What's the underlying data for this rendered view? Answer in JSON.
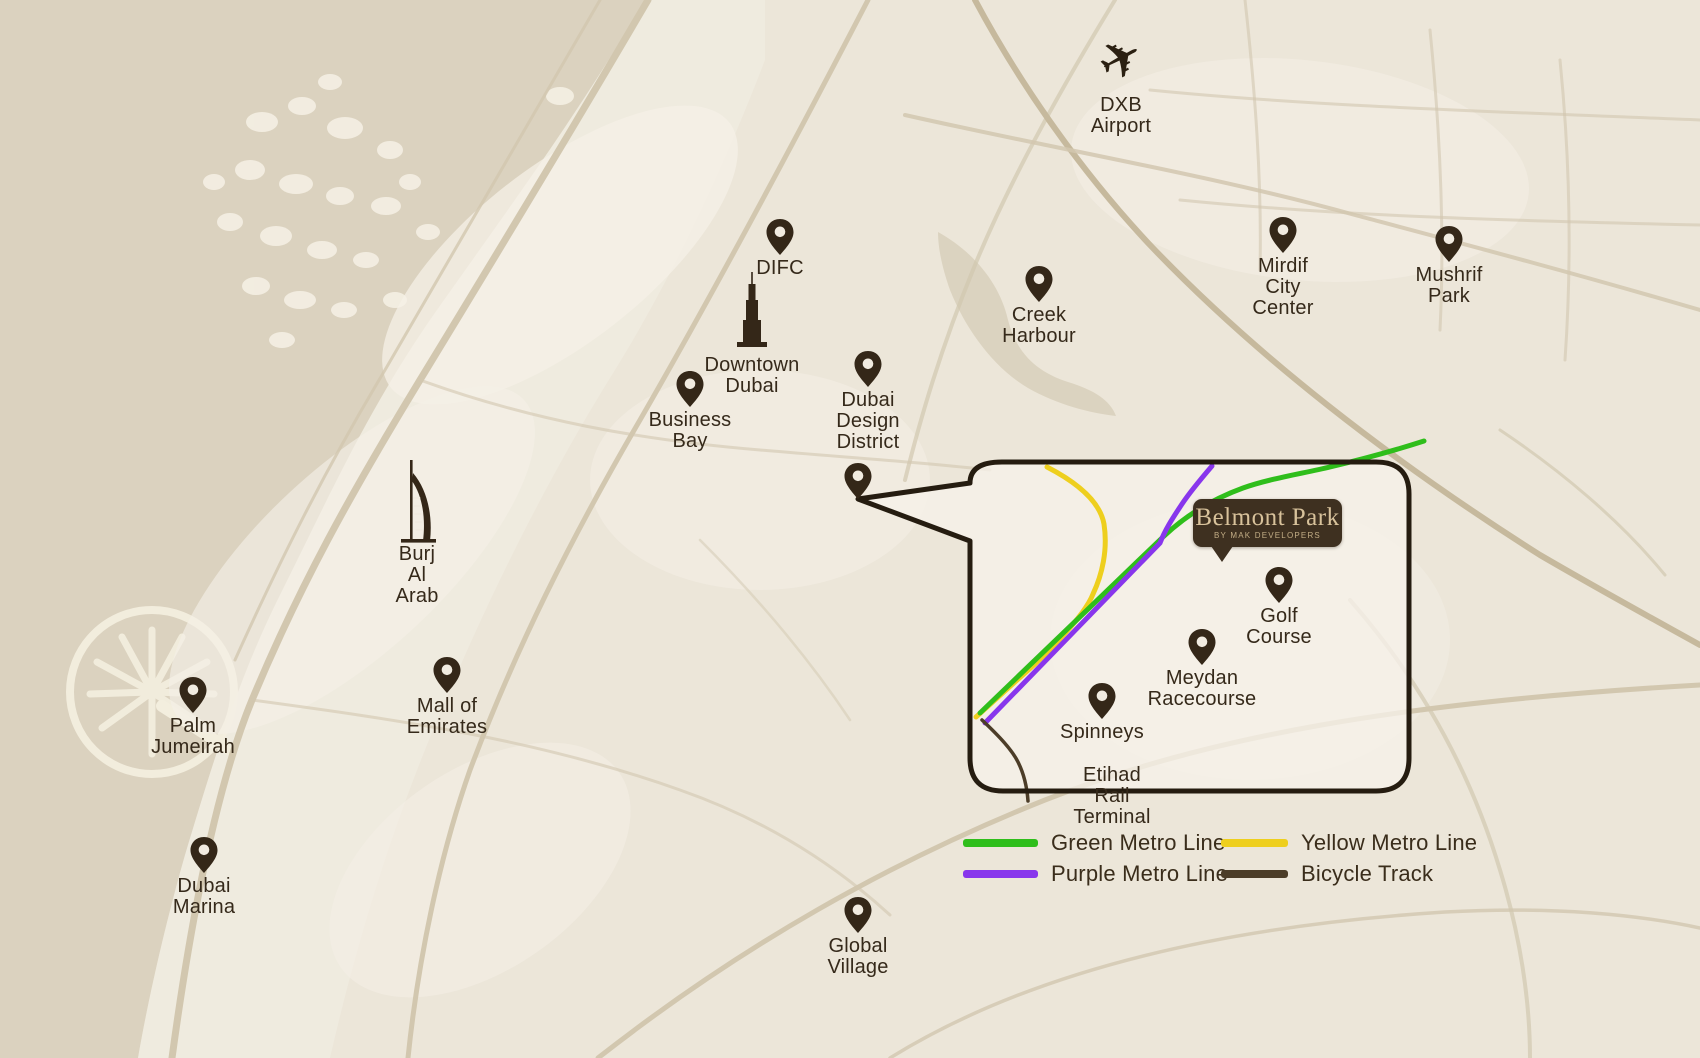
{
  "map": {
    "region": "Dubai",
    "colors": {
      "sea": "#dbd2bf",
      "land": "#ece6d9",
      "light_blocks": "#f4efe6",
      "roads": "#d2c7af",
      "marker": "#342718",
      "label_text": "#35291a",
      "callout_border": "#251c10"
    }
  },
  "landmarks": [
    {
      "id": "dxb-airport",
      "icon": "plane",
      "label": "DXB Airport",
      "x": 1121,
      "y": 92
    },
    {
      "id": "difc",
      "icon": "pin",
      "label": "DIFC",
      "x": 780,
      "y": 255
    },
    {
      "id": "downtown-dubai",
      "icon": "burj-khalifa",
      "label": "Downtown\nDubai",
      "x": 752,
      "y": 352
    },
    {
      "id": "business-bay",
      "icon": "pin",
      "label": "Business\nBay",
      "x": 690,
      "y": 407
    },
    {
      "id": "dubai-design-district",
      "icon": "pin",
      "label": "Dubai Design\nDistrict",
      "x": 868,
      "y": 387
    },
    {
      "id": "creek-harbour",
      "icon": "pin",
      "label": "Creek Harbour",
      "x": 1039,
      "y": 302
    },
    {
      "id": "mirdif-city-center",
      "icon": "pin",
      "label": "Mirdif City\nCenter",
      "x": 1283,
      "y": 253
    },
    {
      "id": "mushrif-park",
      "icon": "pin",
      "label": "Mushrif Park",
      "x": 1449,
      "y": 262
    },
    {
      "id": "burj-al-arab",
      "icon": "burj-al-arab",
      "label": "Burj Al Arab",
      "x": 417,
      "y": 541
    },
    {
      "id": "mall-of-emirates",
      "icon": "pin",
      "label": "Mall of Emirates",
      "x": 447,
      "y": 693
    },
    {
      "id": "palm-jumeirah",
      "icon": "pin",
      "label": "Palm Jumeirah",
      "x": 193,
      "y": 713
    },
    {
      "id": "dubai-marina",
      "icon": "pin",
      "label": "Dubai Marina",
      "x": 204,
      "y": 873
    },
    {
      "id": "global-village",
      "icon": "pin",
      "label": "Global Village",
      "x": 858,
      "y": 933
    },
    {
      "id": "belmont-park-location",
      "icon": "pin",
      "label": "",
      "x": 858,
      "y": 499
    },
    {
      "id": "golf-course",
      "icon": "pin",
      "label": "Golf Course",
      "x": 1279,
      "y": 603
    },
    {
      "id": "meydan-racecourse",
      "icon": "pin",
      "label": "Meydan Racecourse",
      "x": 1202,
      "y": 665
    },
    {
      "id": "spinneys",
      "icon": "pin",
      "label": "Spinneys",
      "x": 1102,
      "y": 719
    },
    {
      "id": "etihad-rail-terminal",
      "icon": "none",
      "label": "Etihad Rail Terminal",
      "x": 1112,
      "y": 762
    }
  ],
  "callout": {
    "logo": {
      "title": "Belmont Park",
      "subtitle": "BY MAK DEVELOPERS",
      "bg_color": "#3e3020",
      "text_color": "#d8c29b"
    }
  },
  "legend": {
    "items": [
      {
        "label": "Green Metro Line",
        "color": "#2fbe1b"
      },
      {
        "label": "Yellow Metro Line",
        "color": "#eecf1e"
      },
      {
        "label": "Purple Metro Line",
        "color": "#8836ec"
      },
      {
        "label": "Bicycle Track",
        "color": "#4c3d28"
      }
    ]
  }
}
